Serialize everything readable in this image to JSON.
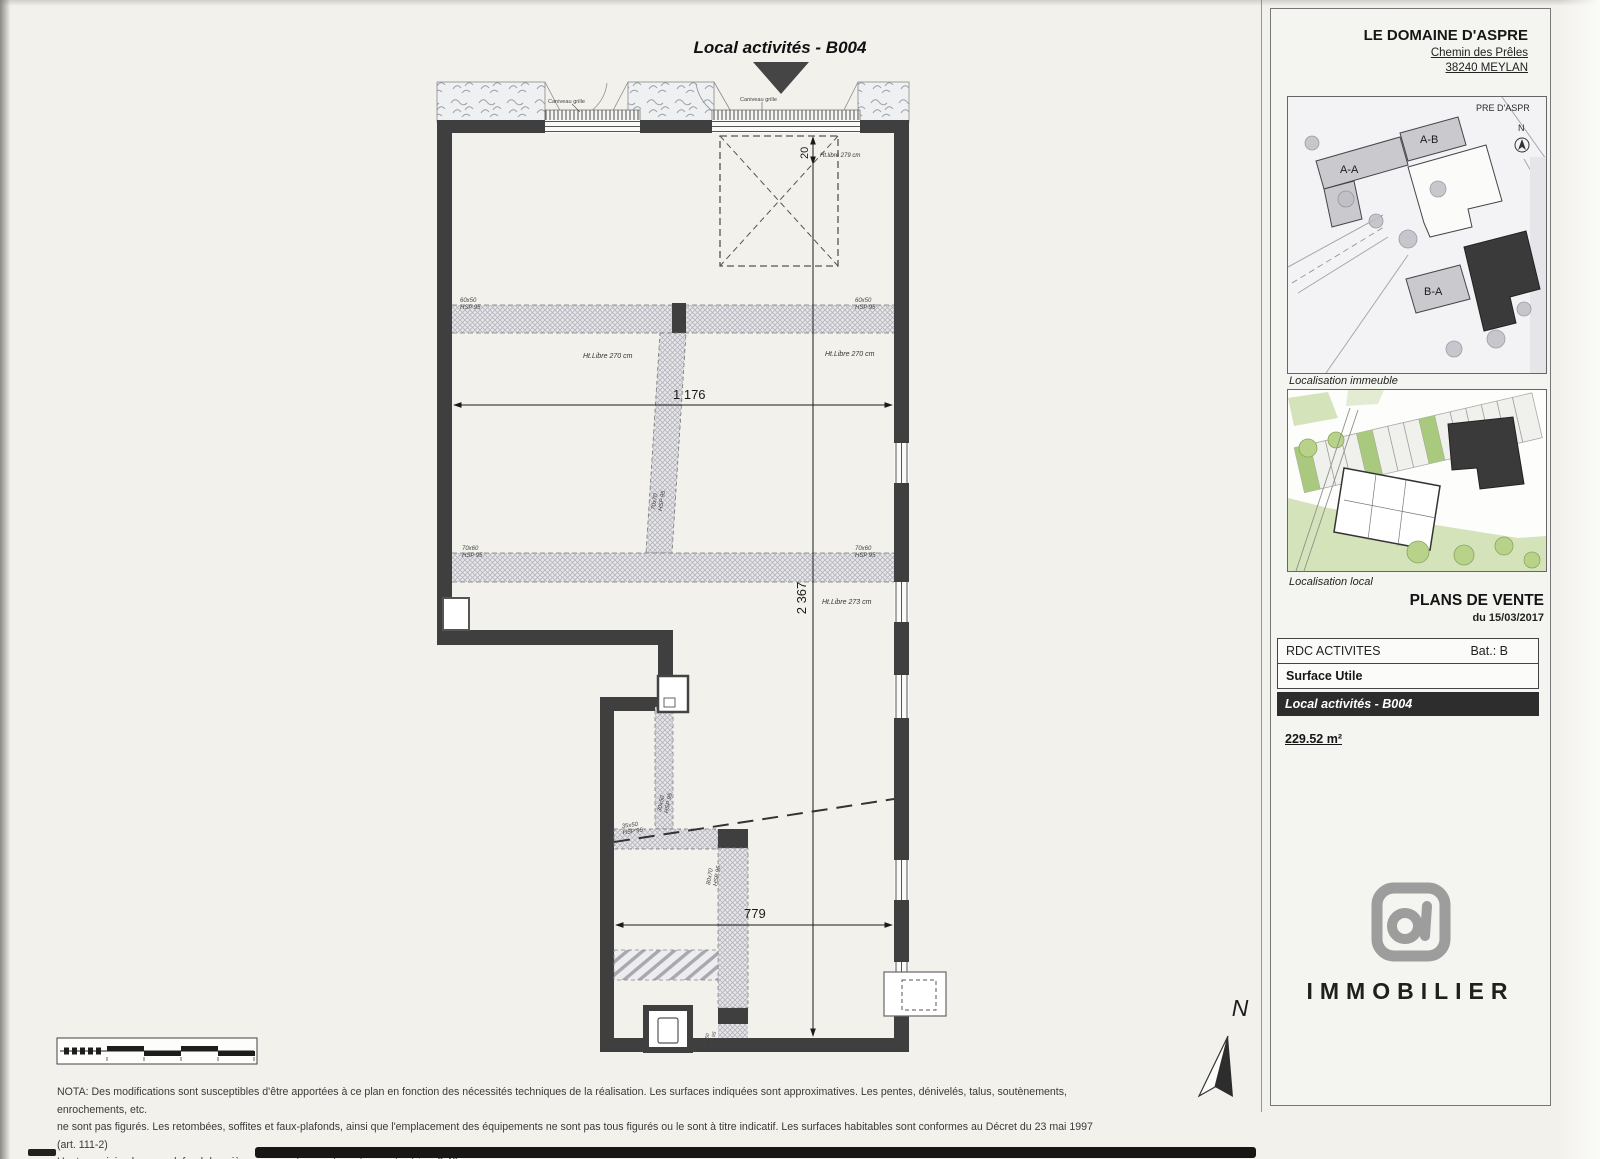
{
  "colors": {
    "wall": "#3f3f3f",
    "dark_row": "#2d2d2d",
    "logo_gray": "#9d9d9d"
  },
  "plan": {
    "title": "Local activités  - B004",
    "dimensions": {
      "width_top": "1 176",
      "height_main": "2 367",
      "width_bottom": "779",
      "entry_gap": "20"
    },
    "heights": {
      "box": "Ht.libre 279 cm",
      "left": "Ht.Libre 270 cm",
      "right": "Ht.Libre 270 cm",
      "lower": "Ht.Libre 273 cm"
    },
    "grille_label_1": "Caniveau grille",
    "grille_label_2": "Caniveau grille",
    "beams": {
      "b1_left": {
        "size": "60x50",
        "hsp": "HSP 95"
      },
      "b1_right": {
        "size": "60x50",
        "hsp": "HSP 95"
      },
      "b2_left": {
        "size": "70x60",
        "hsp": "HSP 95"
      },
      "b2_right": {
        "size": "70x60",
        "hsp": "HSP 95"
      },
      "col_mid": {
        "size": "70x70",
        "hsp": "HSP 95"
      },
      "col_low1": {
        "size": "30x50",
        "hsp": "HSP 95"
      },
      "beam_low": {
        "size": "35x50",
        "hsp": "HSP 95"
      },
      "col_low2": {
        "size": "80x70",
        "hsp": "HSP 95"
      },
      "col_low3": {
        "size": "30x50",
        "hsp": "HSP 95"
      }
    },
    "north": "N"
  },
  "sidebar": {
    "project": "LE DOMAINE D'ASPRE",
    "address_line1": "Chemin des Prêles",
    "address_line2": "38240 MEYLAN",
    "map_immeuble": {
      "area_label": "PRE D'ASPR",
      "north": "N",
      "building_aa": "A-A",
      "building_ab": "A-B",
      "building_ba": "B-A",
      "caption": "Localisation immeuble"
    },
    "map_local": {
      "caption": "Localisation local"
    },
    "plans_title": "PLANS DE VENTE",
    "plans_date": "du 15/03/2017",
    "table": {
      "level": "RDC ACTIVITES",
      "bat": "Bat.: B",
      "surface_label": "Surface Utile",
      "lot": "Local activités  - B004",
      "surface_value": "229.52 m²"
    },
    "logo_text": "IMMOBILIER"
  },
  "footer": {
    "nota_line1": "NOTA: Des modifications sont susceptibles d'être apportées à ce plan en fonction des nécessités techniques de la réalisation. Les surfaces indiquées sont approximatives. Les pentes, dénivelés, talus, soutènements, enrochements, etc.",
    "nota_line2": "ne sont pas figurés. Les retombées, soffites et faux-plafonds, ainsi que l'emplacement des équipements ne sont pas tous figurés ou le sont à titre indicatif. Les surfaces habitables sont conformes au Décret du 23 mai 1997 (art. 111-2)",
    "nota_line3_prefix": "Hauteur minimale sous plafond des pièces principales, sauf mention particulière: ",
    "nota_min_height": "2,40m"
  }
}
